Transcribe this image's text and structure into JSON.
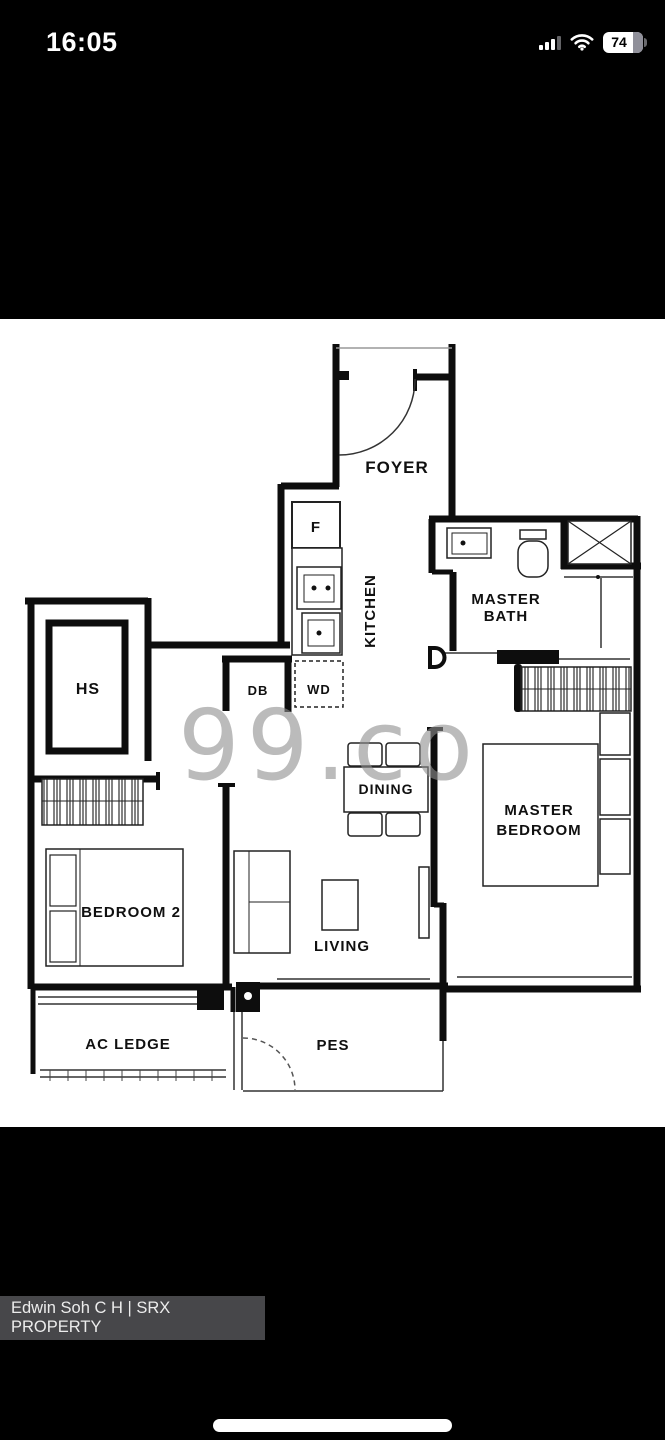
{
  "status_bar": {
    "time": "16:05",
    "battery_percent": "74"
  },
  "image_viewer": {
    "watermark": "99.co",
    "labels": {
      "foyer": "FOYER",
      "fridge": "F",
      "kitchen": "KITCHEN",
      "master_bath": [
        "MASTER",
        "BATH"
      ],
      "household_shelter": "HS",
      "db": "DB",
      "wd": "WD",
      "dining": "DINING",
      "master_bedroom": [
        "MASTER",
        "BEDROOM"
      ],
      "bedroom_2": "BEDROOM 2",
      "living": "LIVING",
      "ac_ledge": "AC LEDGE",
      "pes": "PES"
    }
  },
  "attribution": {
    "agent": "Edwin Soh C H | SRX PROPERTY"
  },
  "colors": {
    "watermark_gray": "#8f8f8f",
    "attribution_bg": "#47474a",
    "wall_black": "#0d0d0d",
    "plan_bg": "#ffffff"
  }
}
